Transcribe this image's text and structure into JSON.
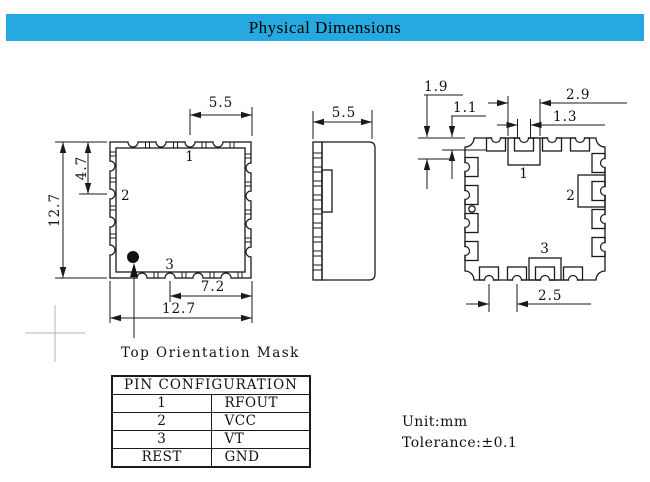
{
  "header": {
    "title": "Physical Dimensions",
    "bg_color": "#26A9E0",
    "text_color": "#000000"
  },
  "top_view": {
    "pin1": "1",
    "pin2": "2",
    "pin3": "3",
    "dim_top_width": "5.5",
    "dim_pin2_offset": "4.7",
    "dim_height": "12.7",
    "dim_pin3_to_edge": "7.2",
    "dim_width": "12.7",
    "annotation": "Top Orientation Mask"
  },
  "side_view": {
    "dim_depth": "5.5"
  },
  "bottom_view": {
    "pin1": "1",
    "pin2": "2",
    "pin3": "3",
    "dim_corner_pad": "1.9",
    "dim_edge_pad": "1.1",
    "dim_pin1_pad": "2.9",
    "dim_hole": "1.3",
    "dim_pad_pitch": "2.5"
  },
  "pin_table": {
    "title": "PIN CONFIGURATION",
    "rows": [
      {
        "pin": "1",
        "signal": "RFOUT"
      },
      {
        "pin": "2",
        "signal": "VCC"
      },
      {
        "pin": "3",
        "signal": "VT"
      },
      {
        "pin": "REST",
        "signal": "GND"
      }
    ]
  },
  "notes": {
    "unit": "Unit:mm",
    "tolerance": "Tolerance:±0.1"
  },
  "colors": {
    "header_bg": "#26A9E0",
    "line": "#1a1a1a",
    "crosshair": "#b3b3b3"
  }
}
